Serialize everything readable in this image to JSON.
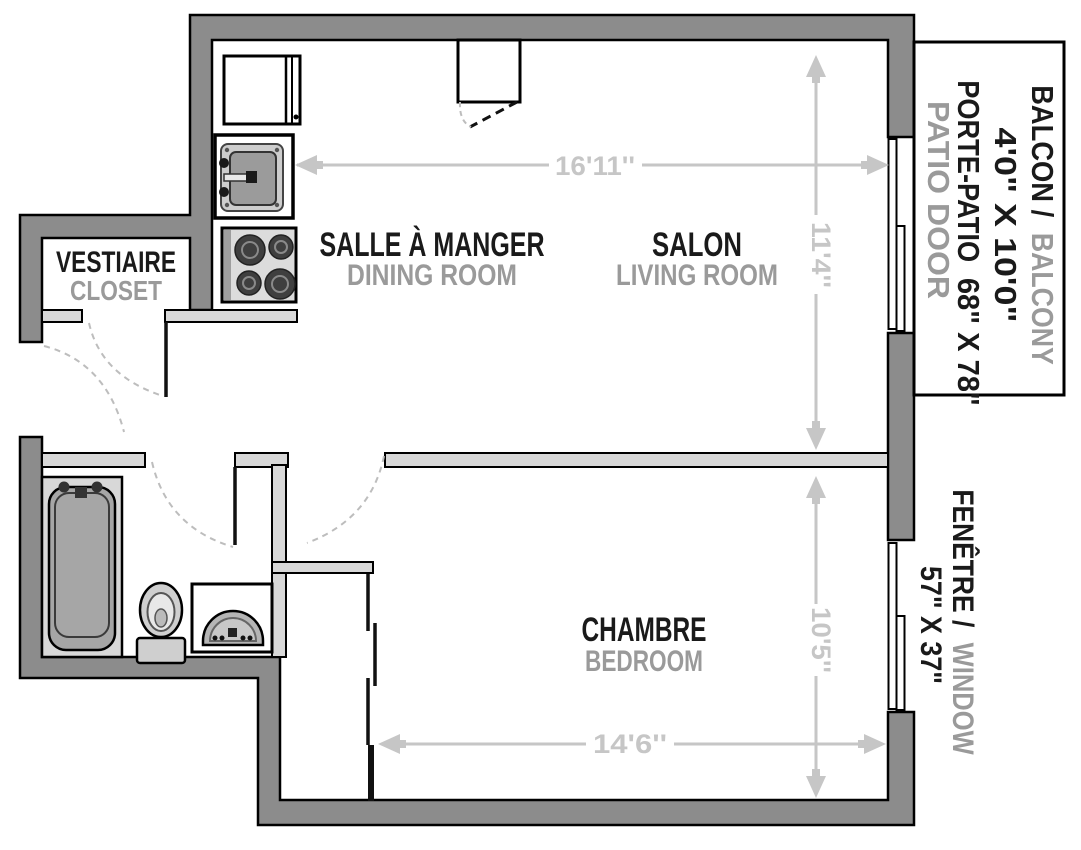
{
  "palette": {
    "background": "#ffffff",
    "exterior_wall": "#8c8c8c",
    "interior_wall": "#d8d8d8",
    "outline": "#000000",
    "dimension_gray": "#c6c6c6",
    "label_primary": "#1a1a1a",
    "label_secondary": "#9a9a9a",
    "fixture_gray": "#a6a6a6"
  },
  "rooms": {
    "vestiaire": {
      "fr": "VESTIAIRE",
      "en": "CLOSET"
    },
    "dining": {
      "fr": "SALLE À MANGER",
      "en": "DINING ROOM"
    },
    "living": {
      "fr": "SALON",
      "en": "LIVING ROOM"
    },
    "bedroom": {
      "fr": "CHAMBRE",
      "en": "BEDROOM"
    }
  },
  "dimensions": {
    "living_width": "16'11''",
    "living_depth": "11'4''",
    "bedroom_depth": "10'5''",
    "bedroom_width": "14'6''"
  },
  "balcony": {
    "name_fr": "BALCON /",
    "name_en": "BALCONY",
    "size": "4'0\" X 10'0\"",
    "door_fr": "PORTE-PATIO",
    "door_size": "68\" X 78\"",
    "door_en": "PATIO DOOR"
  },
  "window": {
    "name_fr": "FENÊTRE /",
    "name_en": "WINDOW",
    "size": "57\" X 37\""
  },
  "fixtures": {
    "kitchen": [
      "refrigerator",
      "kitchen-sink",
      "stove"
    ],
    "bathroom": [
      "bathtub",
      "toilet",
      "bathroom-sink"
    ],
    "openings": [
      "entry-door",
      "patio-door",
      "bedroom-window",
      "closet-sliding-doors"
    ]
  }
}
